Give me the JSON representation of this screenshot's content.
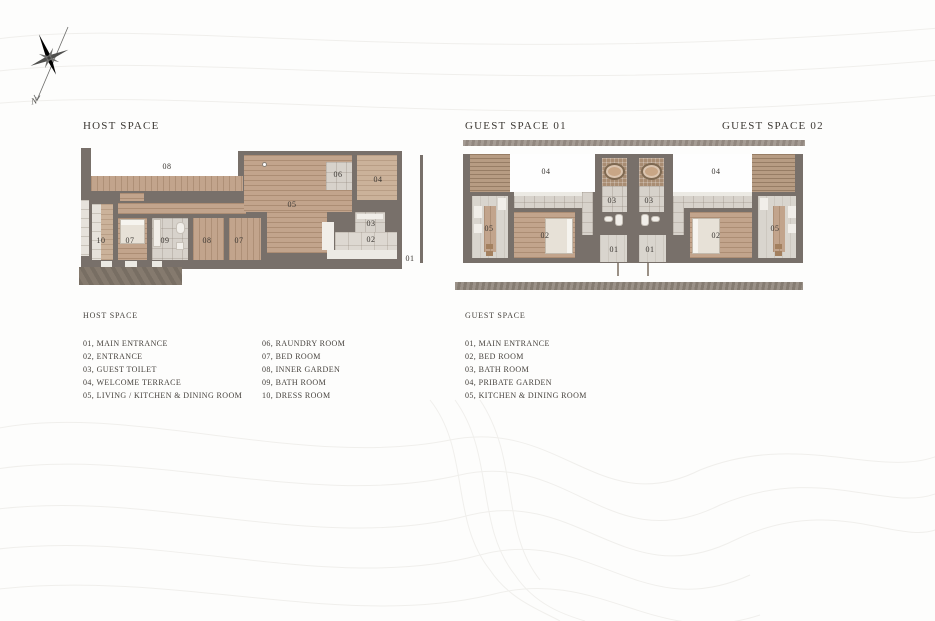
{
  "sections": {
    "host": {
      "title": "HOST SPACE"
    },
    "guest1": {
      "title": "GUEST SPACE 01"
    },
    "guest2": {
      "title": "GUEST SPACE 02"
    }
  },
  "compass": {
    "label": "N"
  },
  "host_plan": {
    "labels": {
      "inner_garden": "08",
      "living": "05",
      "laundry": "06",
      "terrace": "04",
      "toilet": "03",
      "entrance": "02",
      "main_entrance": "01",
      "dress": "10",
      "bed1": "07",
      "bath": "09",
      "inner2": "08",
      "bed2": "07"
    }
  },
  "guest_plan": {
    "labels": {
      "garden_left": "04",
      "garden_right": "04",
      "bath_left": "03",
      "bath_right": "03",
      "bed_left": "02",
      "bed_right": "02",
      "kitchen_left": "05",
      "kitchen_right": "05",
      "entry_left": "01",
      "entry_right": "01"
    }
  },
  "legend": {
    "host": {
      "heading": "HOST SPACE",
      "col1": [
        "01, MAIN ENTRANCE",
        "02, ENTRANCE",
        "03, GUEST TOILET",
        "04, WELCOME TERRACE",
        "05, LIVING / KITCHEN & DINING ROOM"
      ],
      "col2": [
        "06, RAUNDRY ROOM",
        "07, BED ROOM",
        "08, INNER GARDEN",
        "09, BATH ROOM",
        "10, DRESS ROOM"
      ]
    },
    "guest": {
      "heading": "GUEST SPACE",
      "items": [
        "01, MAIN ENTRANCE",
        "02, BED ROOM",
        "03, BATH ROOM",
        "04, PRIBATE GARDEN",
        "05, KITCHEN & DINING ROOM"
      ]
    }
  },
  "colors": {
    "wall": "#78706a",
    "wood": "#c2a48c",
    "wood_light": "#cbb29a",
    "deck": "#b79c83",
    "tile": "#d7d2cb",
    "tile_light": "#ddd8d1",
    "mosaic": "#a98d73",
    "tub": "#c8a686",
    "concrete": "#9b9188",
    "ground": "#857a6e",
    "white_area": "#fefefe",
    "bed": "#e7e1d7",
    "text": "#3c3833",
    "contour": "#f0efec"
  }
}
